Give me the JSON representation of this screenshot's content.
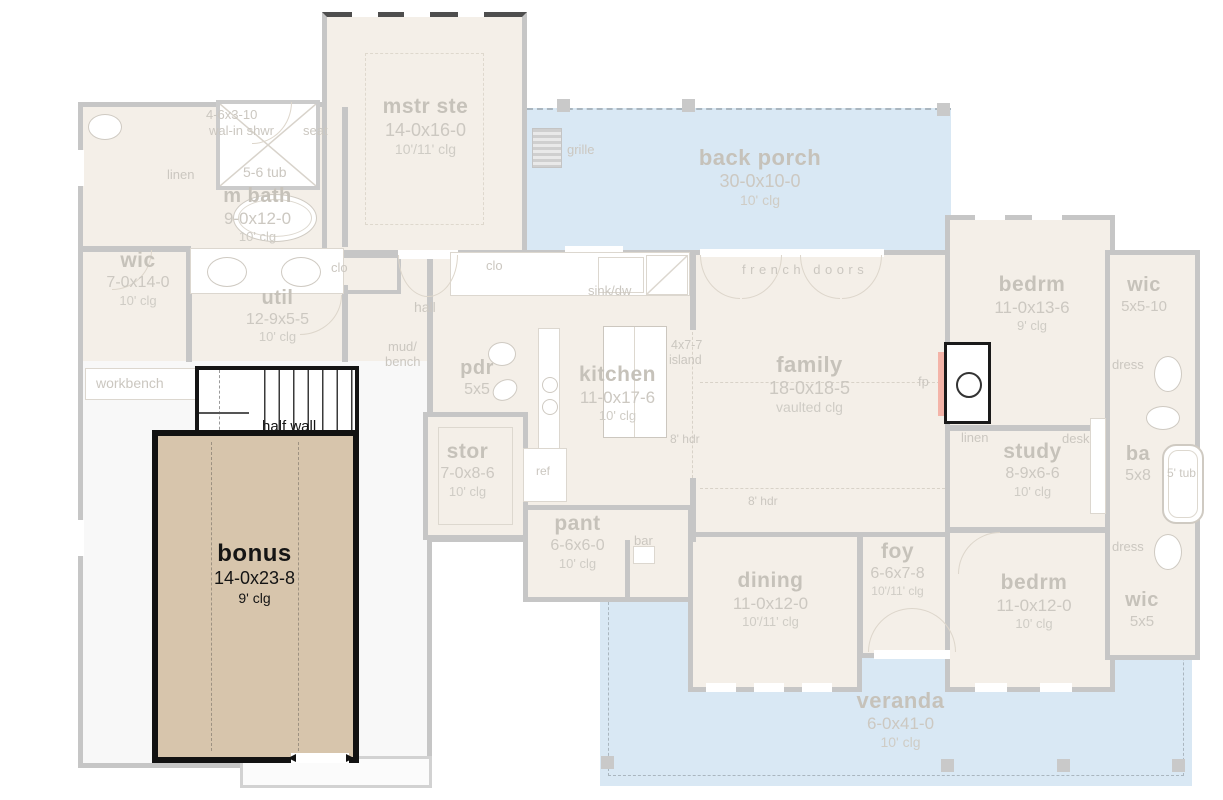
{
  "plan": {
    "rooms": {
      "mstr_ste": {
        "name": "mstr ste",
        "dims": "14-0x16-0",
        "clg": "10'/11' clg"
      },
      "back_porch": {
        "name": "back porch",
        "dims": "30-0x10-0",
        "clg": "10' clg"
      },
      "m_bath": {
        "name": "m bath",
        "dims": "9-0x12-0",
        "clg": "10' clg"
      },
      "wic_left": {
        "name": "wic",
        "dims": "7-0x14-0",
        "clg": "10' clg"
      },
      "util": {
        "name": "util",
        "dims": "12-9x5-5",
        "clg": "10' clg"
      },
      "bonus": {
        "name": "bonus",
        "dims": "14-0x23-8",
        "clg": "9' clg"
      },
      "stor": {
        "name": "stor",
        "dims": "7-0x8-6",
        "clg": "10' clg"
      },
      "pdr": {
        "name": "pdr",
        "dims": "5x5"
      },
      "kitchen": {
        "name": "kitchen",
        "dims": "11-0x17-6",
        "clg": "10' clg"
      },
      "family": {
        "name": "family",
        "dims": "18-0x18-5",
        "clg": "vaulted clg"
      },
      "pant": {
        "name": "pant",
        "dims": "6-6x6-0",
        "clg": "10' clg"
      },
      "dining": {
        "name": "dining",
        "dims": "11-0x12-0",
        "clg": "10'/11' clg"
      },
      "foy": {
        "name": "foy",
        "dims": "6-6x7-8",
        "clg": "10'/11' clg"
      },
      "bedrm_top": {
        "name": "bedrm",
        "dims": "11-0x13-6",
        "clg": "9' clg"
      },
      "study": {
        "name": "study",
        "dims": "8-9x6-6",
        "clg": "10' clg"
      },
      "bedrm_bot": {
        "name": "bedrm",
        "dims": "11-0x12-0",
        "clg": "10' clg"
      },
      "ba": {
        "name": "ba",
        "dims": "5x8"
      },
      "wic_tr": {
        "name": "wic",
        "dims": "5x5-10"
      },
      "wic_br": {
        "name": "wic",
        "dims": "5x5"
      },
      "veranda": {
        "name": "veranda",
        "dims": "6-0x41-0",
        "clg": "10' clg"
      }
    },
    "labels": {
      "shower_dims": "4-6x3-10",
      "shower": "wal-in shwr",
      "seat": "seat",
      "tub_56": "5-6 tub",
      "linen_a": "linen",
      "linen_b": "linen",
      "clo_a": "clo",
      "clo_b": "clo",
      "hall": "hall",
      "workbench": "workbench",
      "half_wall": "half wall",
      "mud": "mud/",
      "bench": "bench",
      "sink_dw": "sink/dw",
      "island_dims": "4x7-7",
      "island": "island",
      "french_doors": "french doors",
      "hdr_a": "8' hdr",
      "hdr_b": "8' hdr",
      "fp": "fp",
      "grille": "grille",
      "ref": "ref",
      "bar": "bar",
      "desk": "desk",
      "dress_a": "dress",
      "dress_b": "dress",
      "tub_5": "5' tub"
    },
    "colors": {
      "porch": "#d9e8f4",
      "room": "#f4efe8",
      "bonus_fill": "#d7c5ac",
      "wall": "#c6c6c6",
      "highlight_border": "#121212",
      "fireplace_accent": "#f4b4a8",
      "label_text": "#c6c2ba"
    }
  }
}
